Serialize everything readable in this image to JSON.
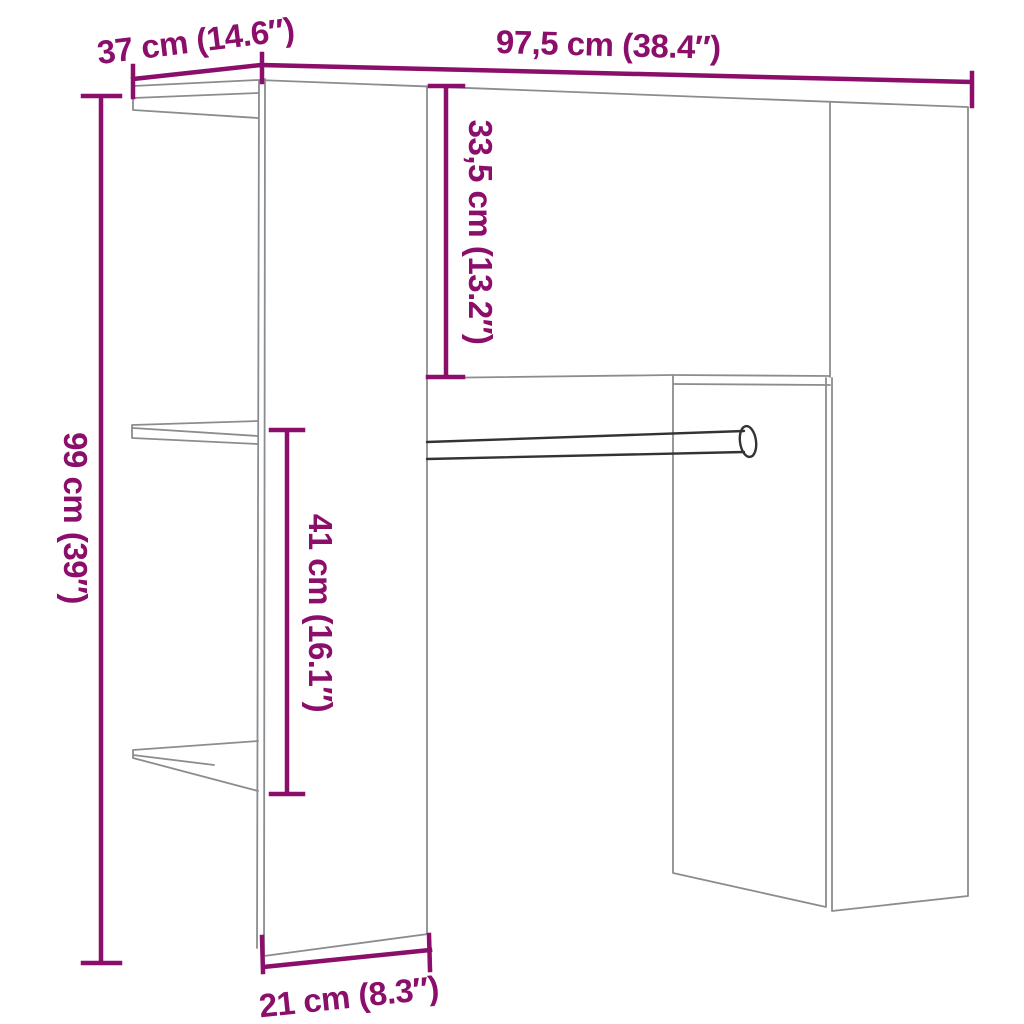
{
  "title": "Hallway unit dimension diagram",
  "colors": {
    "background": "#ffffff",
    "dimension": "#8b0e6b",
    "outline": "#8a8d90",
    "rod": "#333336"
  },
  "dimensions": {
    "top_depth": "37 cm (14.6″)",
    "top_width": "97,5 cm (38.4″)",
    "cabinet_height": "33,5 cm (13.2″)",
    "total_height": "99 cm (39″)",
    "rail_height": "41 cm (16.1″)",
    "panel_depth": "21 cm (8.3″)"
  }
}
